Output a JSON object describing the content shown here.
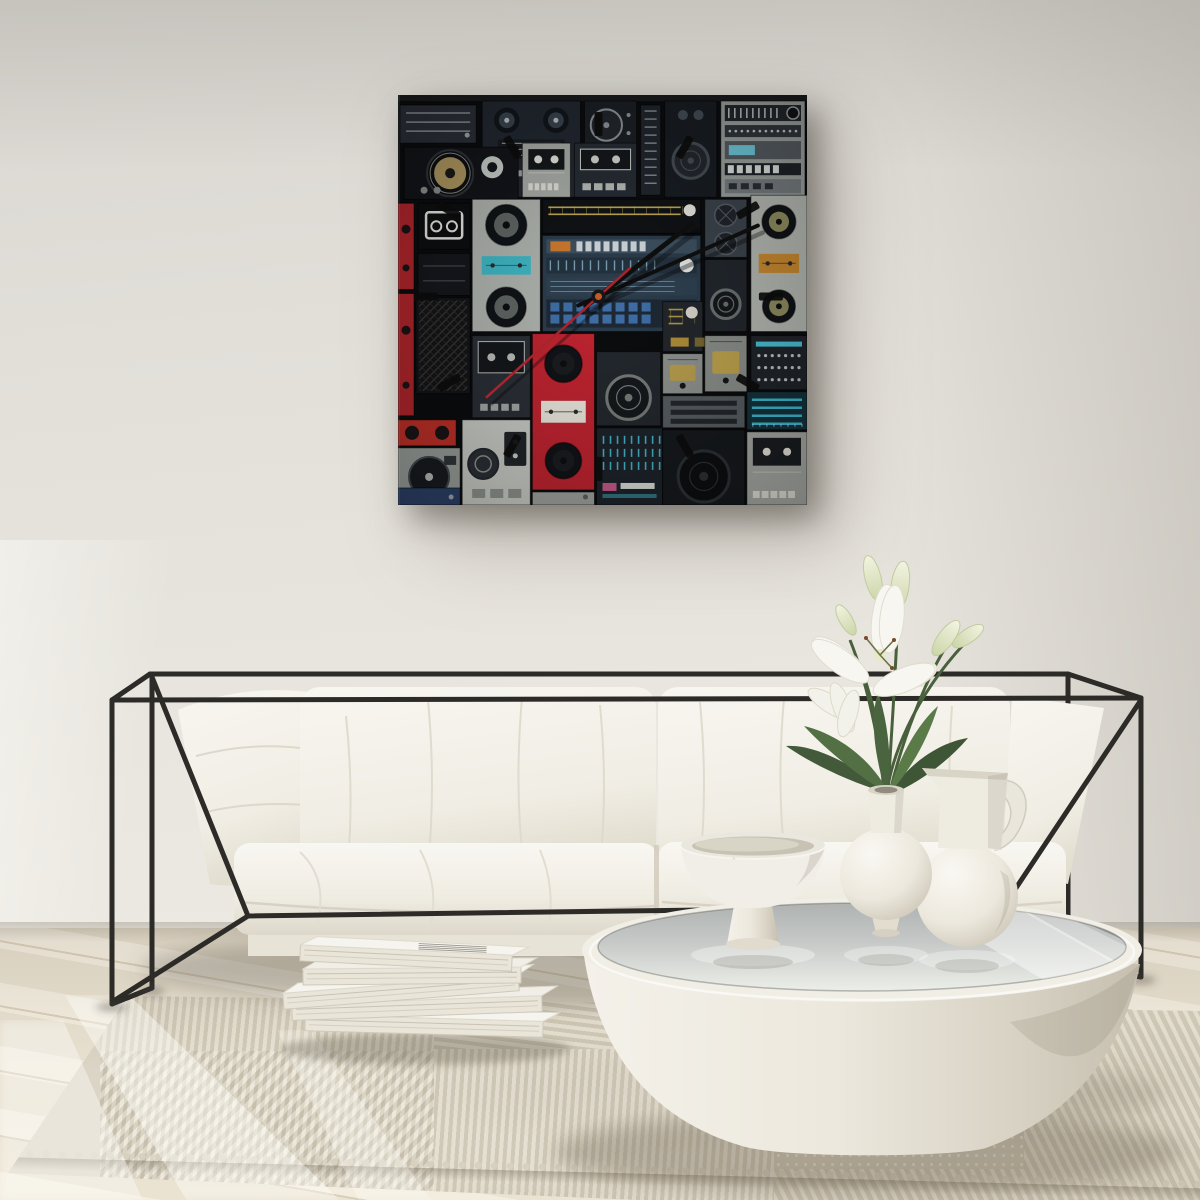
{
  "scene": {
    "description": "Bright minimalist living room: square boombox-collage wall clock on an off-white wall above a black wireframe sofa with white cushions; round white pedestal coffee table with glossy top holding a footed bowl, a round vase with white lilies and a white pitcher; stack of magazines on a textured cream rug over whitewashed wood flooring."
  },
  "counts": {
    "clock_hour_markers": 12,
    "magazines": 5,
    "vases_on_table": 3,
    "sofa_back_cushions": 2,
    "sofa_seat_cushions": 2
  },
  "palette": {
    "wall_top": "#d9d6d1",
    "wall_mid": "#e2dfd9",
    "wall_bottom": "#eae7e0",
    "floor_light": "#ece5d5",
    "floor_dark": "#ddd5c5",
    "floor_seam": "#9e8668",
    "rug_base": "#dcd5c6",
    "rug_stripe_light": "#e7e1d3",
    "rug_stripe_dark": "#d0c8b6",
    "sofa_frame": "#2d2b28",
    "cushion": "#f6f4ee",
    "cushion_shade": "#e4e0d3",
    "table_base": "#efece4",
    "glass_gray": "#bcbfbd",
    "vase_white": "#f1eee7",
    "leaf_green": "#46603b",
    "stem_green": "#49603c",
    "lily_white": "#f7f6f0",
    "bud_green": "#dde3bb",
    "canvas_bg": "#0b0c0e",
    "art_red": "#bf2430",
    "art_teal": "#3fc3da",
    "art_gold": "#c9b353",
    "art_silver": "#aeb2ad"
  },
  "artwork": {
    "label": "vintage-boombox-collage-wall-clock",
    "canvas": {
      "x": 398,
      "y": 95,
      "w": 408,
      "h": 409,
      "background": "#0b0c0e",
      "top_edge": "#1a1b1d"
    },
    "clock": {
      "center_x": 200,
      "center_y": 201,
      "marker_count": 12,
      "marker_radius": 172,
      "marker_w": 8,
      "marker_len": 24,
      "marker_color": "#0b0b0b",
      "hour_angle": 52,
      "hour_len": 118,
      "minute_angle": 66,
      "minute_len": 174,
      "second_angle": 228,
      "second_len": 150,
      "second_tail": 42,
      "hand_color": "#0e0e0e",
      "second_color": "#a8242c",
      "hub_color": "#16161a",
      "hub_dot": "#c05a28"
    },
    "tiles": [
      {
        "type": "receiver",
        "x": 2,
        "y": 10,
        "w": 76,
        "h": 38,
        "base": "#2a2f37",
        "a": "#9fa6a8"
      },
      {
        "type": "boombox2",
        "x": 84,
        "y": 6,
        "w": 98,
        "h": 96,
        "base": "#222831",
        "a": "#39434e",
        "b": "#b9c0c4"
      },
      {
        "type": "reels",
        "x": 186,
        "y": 6,
        "w": 52,
        "h": 96,
        "base": "#1b2026",
        "a": "#8d949a"
      },
      {
        "type": "eqv",
        "x": 242,
        "y": 10,
        "w": 20,
        "h": 90,
        "base": "#20262d",
        "a": "#aeb6b8"
      },
      {
        "type": "speakerbox",
        "x": 266,
        "y": 6,
        "w": 52,
        "h": 96,
        "base": "#181d23",
        "a": "#454d55",
        "b": "#23282e"
      },
      {
        "type": "silverstack",
        "x": 322,
        "y": 6,
        "w": 84,
        "h": 96,
        "base": "#9ba19e",
        "a": "#6ecadb",
        "b": "#1c1f22"
      },
      {
        "type": "goldspeaker",
        "x": 6,
        "y": 52,
        "w": 114,
        "h": 52,
        "base": "#121419",
        "a": "#ad9760",
        "b": "#c8cdc9"
      },
      {
        "type": "redsliver",
        "x": 0,
        "y": 108,
        "w": 16,
        "h": 86,
        "base": "#b2262c",
        "a": "#1c1416"
      },
      {
        "type": "tapedeck",
        "x": 124,
        "y": 48,
        "w": 48,
        "h": 54,
        "base": "#a7aba6",
        "a": "#15181c",
        "b": "#e4e2da"
      },
      {
        "type": "tapedeck2",
        "x": 176,
        "y": 48,
        "w": 62,
        "h": 54,
        "base": "#262c34",
        "a": "#cfd3cd",
        "b": "#14171b"
      },
      {
        "type": "cassetteicon",
        "x": 20,
        "y": 108,
        "w": 52,
        "h": 46,
        "base": "#0d0e10",
        "a": "#e8e6df"
      },
      {
        "type": "fillpanel",
        "x": 20,
        "y": 158,
        "w": 52,
        "h": 42,
        "base": "#15171b",
        "a": "#3a3f46"
      },
      {
        "type": "boombox2v",
        "x": 74,
        "y": 104,
        "w": 68,
        "h": 132,
        "base": "#aeb2ad",
        "a": "#5f6563",
        "b": "#3fb6c4"
      },
      {
        "type": "dial",
        "x": 144,
        "y": 104,
        "w": 158,
        "h": 34,
        "base": "#101215",
        "a": "#c9b353",
        "b": "#e8e6df"
      },
      {
        "type": "ampblue",
        "x": 144,
        "y": 140,
        "w": 158,
        "h": 96,
        "base": "#2c3c4b",
        "a": "#8fb9cd",
        "b": "#cd7a2e"
      },
      {
        "type": "vent",
        "x": 306,
        "y": 104,
        "w": 42,
        "h": 58,
        "base": "#3c434b",
        "a": "#20252b"
      },
      {
        "type": "speakerbox",
        "x": 306,
        "y": 164,
        "w": 42,
        "h": 72,
        "base": "#22272d",
        "a": "#6c7270",
        "b": "#15181c"
      },
      {
        "type": "boombox2v",
        "x": 352,
        "y": 100,
        "w": 56,
        "h": 136,
        "base": "#b5b9b2",
        "a": "#8f8d60",
        "b": "#c98a30"
      },
      {
        "type": "grille",
        "x": 18,
        "y": 202,
        "w": 54,
        "h": 96,
        "base": "#131519",
        "a": "#6d6248"
      },
      {
        "type": "redsliver",
        "x": 0,
        "y": 198,
        "w": 16,
        "h": 122,
        "base": "#b2262c",
        "a": "#1c1416"
      },
      {
        "type": "tapedeck2",
        "x": 74,
        "y": 240,
        "w": 58,
        "h": 82,
        "base": "#2a2f36",
        "a": "#b9bdb8",
        "b": "#14171b"
      },
      {
        "type": "dial",
        "x": 264,
        "y": 206,
        "w": 40,
        "h": 50,
        "base": "#23272c",
        "a": "#b99f4e",
        "b": "#d8d6cc"
      },
      {
        "type": "tape",
        "x": 264,
        "y": 258,
        "w": 40,
        "h": 40,
        "base": "#8f938f",
        "a": "#b99f4e"
      },
      {
        "type": "tape",
        "x": 306,
        "y": 240,
        "w": 42,
        "h": 56,
        "base": "#8b8f8a",
        "a": "#bfa44e"
      },
      {
        "type": "panel",
        "x": 352,
        "y": 240,
        "w": 56,
        "h": 54,
        "base": "#20252b",
        "a": "#cfd4d0",
        "b": "#49c2d6"
      },
      {
        "type": "redmini",
        "x": 0,
        "y": 324,
        "w": 58,
        "h": 26,
        "base": "#c03028",
        "a": "#1a1517"
      },
      {
        "type": "turntable",
        "x": 0,
        "y": 352,
        "w": 62,
        "h": 58,
        "base": "#9aa09c",
        "a": "#181b1f"
      },
      {
        "type": "recorder",
        "x": 64,
        "y": 324,
        "w": 68,
        "h": 85,
        "base": "#c8cbc5",
        "a": "#23272b",
        "b": "#8e938e"
      },
      {
        "type": "receiver",
        "x": 0,
        "y": 392,
        "w": 62,
        "h": 17,
        "base": "#2c4168",
        "a": "#9fa6b0"
      },
      {
        "type": "boombox2v",
        "x": 134,
        "y": 238,
        "w": 62,
        "h": 156,
        "base": "#bf2430",
        "a": "#1a1c20",
        "b": "#e8e6dc"
      },
      {
        "type": "receiver",
        "x": 134,
        "y": 396,
        "w": 62,
        "h": 13,
        "base": "#9ea29d",
        "a": "#5a5f5c"
      },
      {
        "type": "speakerbox",
        "x": 198,
        "y": 256,
        "w": 64,
        "h": 74,
        "base": "#23282e",
        "a": "#767c78",
        "b": "#15181c"
      },
      {
        "type": "tealeq",
        "x": 198,
        "y": 332,
        "w": 66,
        "h": 77,
        "base": "#1c232a",
        "a": "#4ac3d8",
        "b": "#c85a8a"
      },
      {
        "type": "slots",
        "x": 264,
        "y": 300,
        "w": 82,
        "h": 32,
        "base": "#575d61",
        "a": "#23272b"
      },
      {
        "type": "speakerbox",
        "x": 264,
        "y": 334,
        "w": 82,
        "h": 75,
        "base": "#16191d",
        "a": "#2c3136",
        "b": "#0c0e10"
      },
      {
        "type": "eqh",
        "x": 348,
        "y": 296,
        "w": 60,
        "h": 38,
        "base": "#15323c",
        "a": "#3fc3da"
      },
      {
        "type": "tapedeck",
        "x": 348,
        "y": 336,
        "w": 60,
        "h": 73,
        "base": "#a6aaa4",
        "a": "#1a1d21",
        "b": "#e8e6dd"
      }
    ]
  }
}
